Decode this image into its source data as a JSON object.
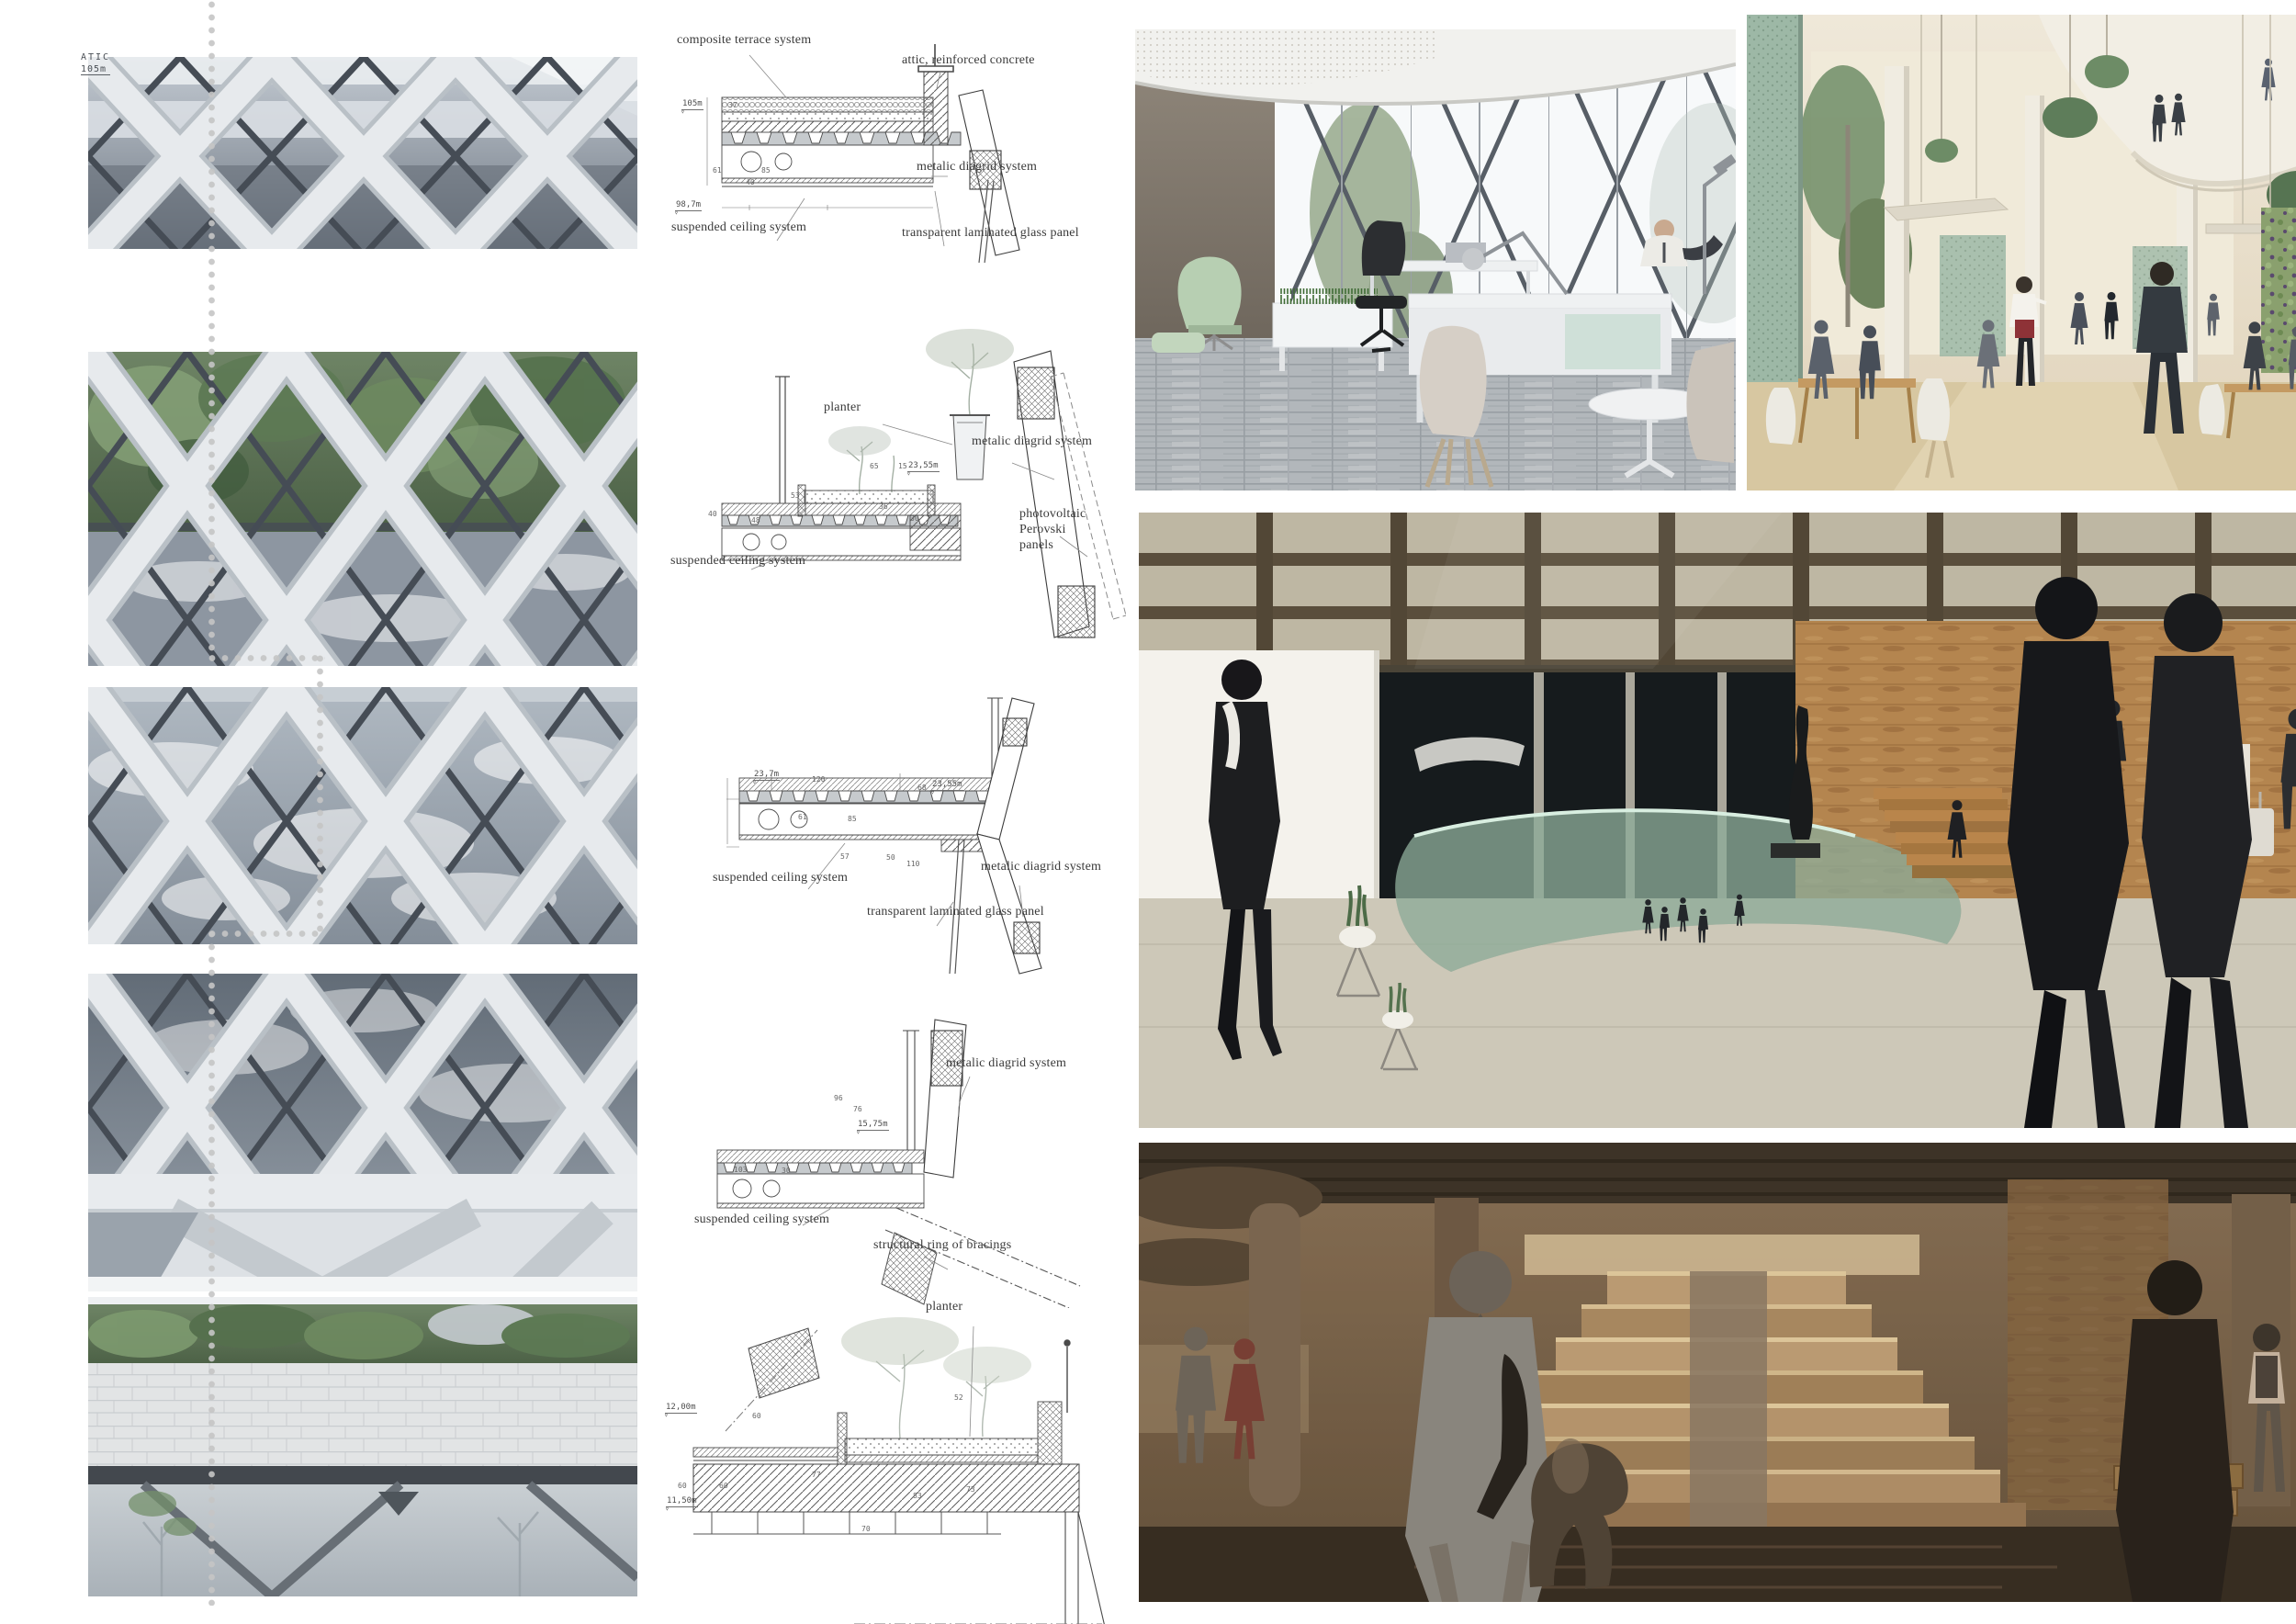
{
  "palette": {
    "label_ink": "#3a3a3a",
    "dim_ink": "#666666",
    "dot_grey": "#c5c5c5",
    "facade_lattice": "#e7eaed",
    "facade_lattice_edge": "#b9c0c6",
    "facade_glass_dark": "#5d6670",
    "facade_glass_mid": "#8d96a1",
    "facade_sky": "#f3f5f7",
    "facade_mullion": "#454c55",
    "foliage_dark": "#4c6146",
    "foliage_mid": "#6e8465",
    "foliage_light": "#85a077",
    "stone_wall": "#e2e4e5",
    "plinth_dark": "#43484e",
    "office_wall_brown": "#867d72",
    "office_floor": "#a9aeb2",
    "office_desk": "#eff1f2",
    "office_chair_green": "#b7cfb2",
    "office_chair_dark": "#2c2e31",
    "office_mullion": "#575e66",
    "atrium_cream": "#ece5d4",
    "atrium_floor": "#d7c7a1",
    "atrium_screen_green": "#9db8a6",
    "atrium_plant": "#5e7d5a",
    "atrium_wood": "#c49a62",
    "atrium_suit": "#343a40",
    "atrium_apron_red": "#8e3237",
    "lobby_beam": "#6a5c49",
    "lobby_skylight": "#f1ecd8",
    "lobby_dark_glass": "#161b1d",
    "lobby_white_wall": "#f4f2ec",
    "lobby_travertine": "#b4854f",
    "lobby_floor": "#cdc8b8",
    "lobby_glass_green": "#a5cbb5",
    "lobby_stair": "#b9854b",
    "figure_dark": "#1b1d20",
    "base_ceiling": "#3a3126",
    "base_wall": "#6e5a45",
    "base_step": "#c2a178",
    "base_step_glow": "#e7d0a2",
    "base_floor": "#342b20",
    "base_figure_grey": "#8d8a84"
  },
  "facade_strip": {
    "marker": {
      "name": "ATIC",
      "level": "105m"
    }
  },
  "details": {
    "d1": {
      "labels": {
        "terrace": "composite terrace system",
        "attic": "attic, reinforced concrete",
        "diagrid": "metalic diagrid system",
        "ceiling": "suspended ceiling system",
        "glass": "transparent laminated glass panel"
      },
      "levels": {
        "upper": "105m",
        "lower": "98,7m"
      },
      "dims": [
        "61",
        "85",
        "40",
        "37"
      ]
    },
    "d2": {
      "labels": {
        "planter": "planter",
        "diagrid": "metalic diagrid system",
        "pv": "photovoltaic Perovski panels",
        "ceiling": "suspended ceiling system"
      },
      "levels": {
        "terrace": "23,55m"
      },
      "dims": [
        "65",
        "15",
        "53",
        "40",
        "48",
        "36",
        "30"
      ]
    },
    "d3": {
      "labels": {
        "ceiling": "suspended ceiling system",
        "diagrid": "metalic diagrid system",
        "glass": "transparent laminated glass panel"
      },
      "levels": {
        "left": "23,7m",
        "right": "23,55m"
      },
      "dims": [
        "120",
        "61",
        "85",
        "57",
        "50",
        "110",
        "68"
      ]
    },
    "d4": {
      "labels": {
        "diagrid": "metalic diagrid system",
        "ceiling": "suspended ceiling system",
        "ring": "structural ring of bracings"
      },
      "levels": {
        "node": "15,75m"
      },
      "dims": [
        "96",
        "76",
        "103",
        "30"
      ]
    },
    "d5": {
      "labels": {
        "planter": "planter"
      },
      "levels": {
        "upper": "12,00m",
        "lower": "11,50m"
      },
      "dims": [
        "52",
        "60",
        "77",
        "60",
        "60",
        "83",
        "70",
        "73"
      ]
    }
  }
}
